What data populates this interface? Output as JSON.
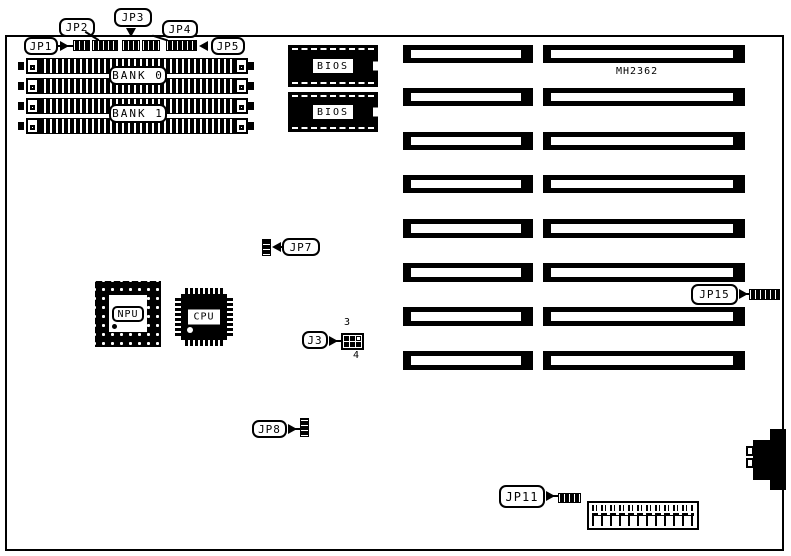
{
  "diagram": {
    "model": "MH2362",
    "jumpers": {
      "jp1": {
        "label": "JP1"
      },
      "jp2": {
        "label": "JP2"
      },
      "jp3": {
        "label": "JP3"
      },
      "jp4": {
        "label": "JP4"
      },
      "jp5": {
        "label": "JP5"
      },
      "jp7": {
        "label": "JP7"
      },
      "jp8": {
        "label": "JP8"
      },
      "jp11": {
        "label": "JP11"
      },
      "jp15": {
        "label": "JP15"
      }
    },
    "memory": {
      "bank0": "BANK 0",
      "bank1": "BANK 1"
    },
    "chips": {
      "bios1": "BIOS",
      "bios2": "BIOS",
      "npu": "NPU",
      "cpu": "CPU"
    },
    "connectors": {
      "j3": {
        "label": "J3",
        "pin_top": "3",
        "pin_bottom": "4"
      }
    }
  },
  "colors": {
    "line": "#000000",
    "background": "#ffffff"
  }
}
